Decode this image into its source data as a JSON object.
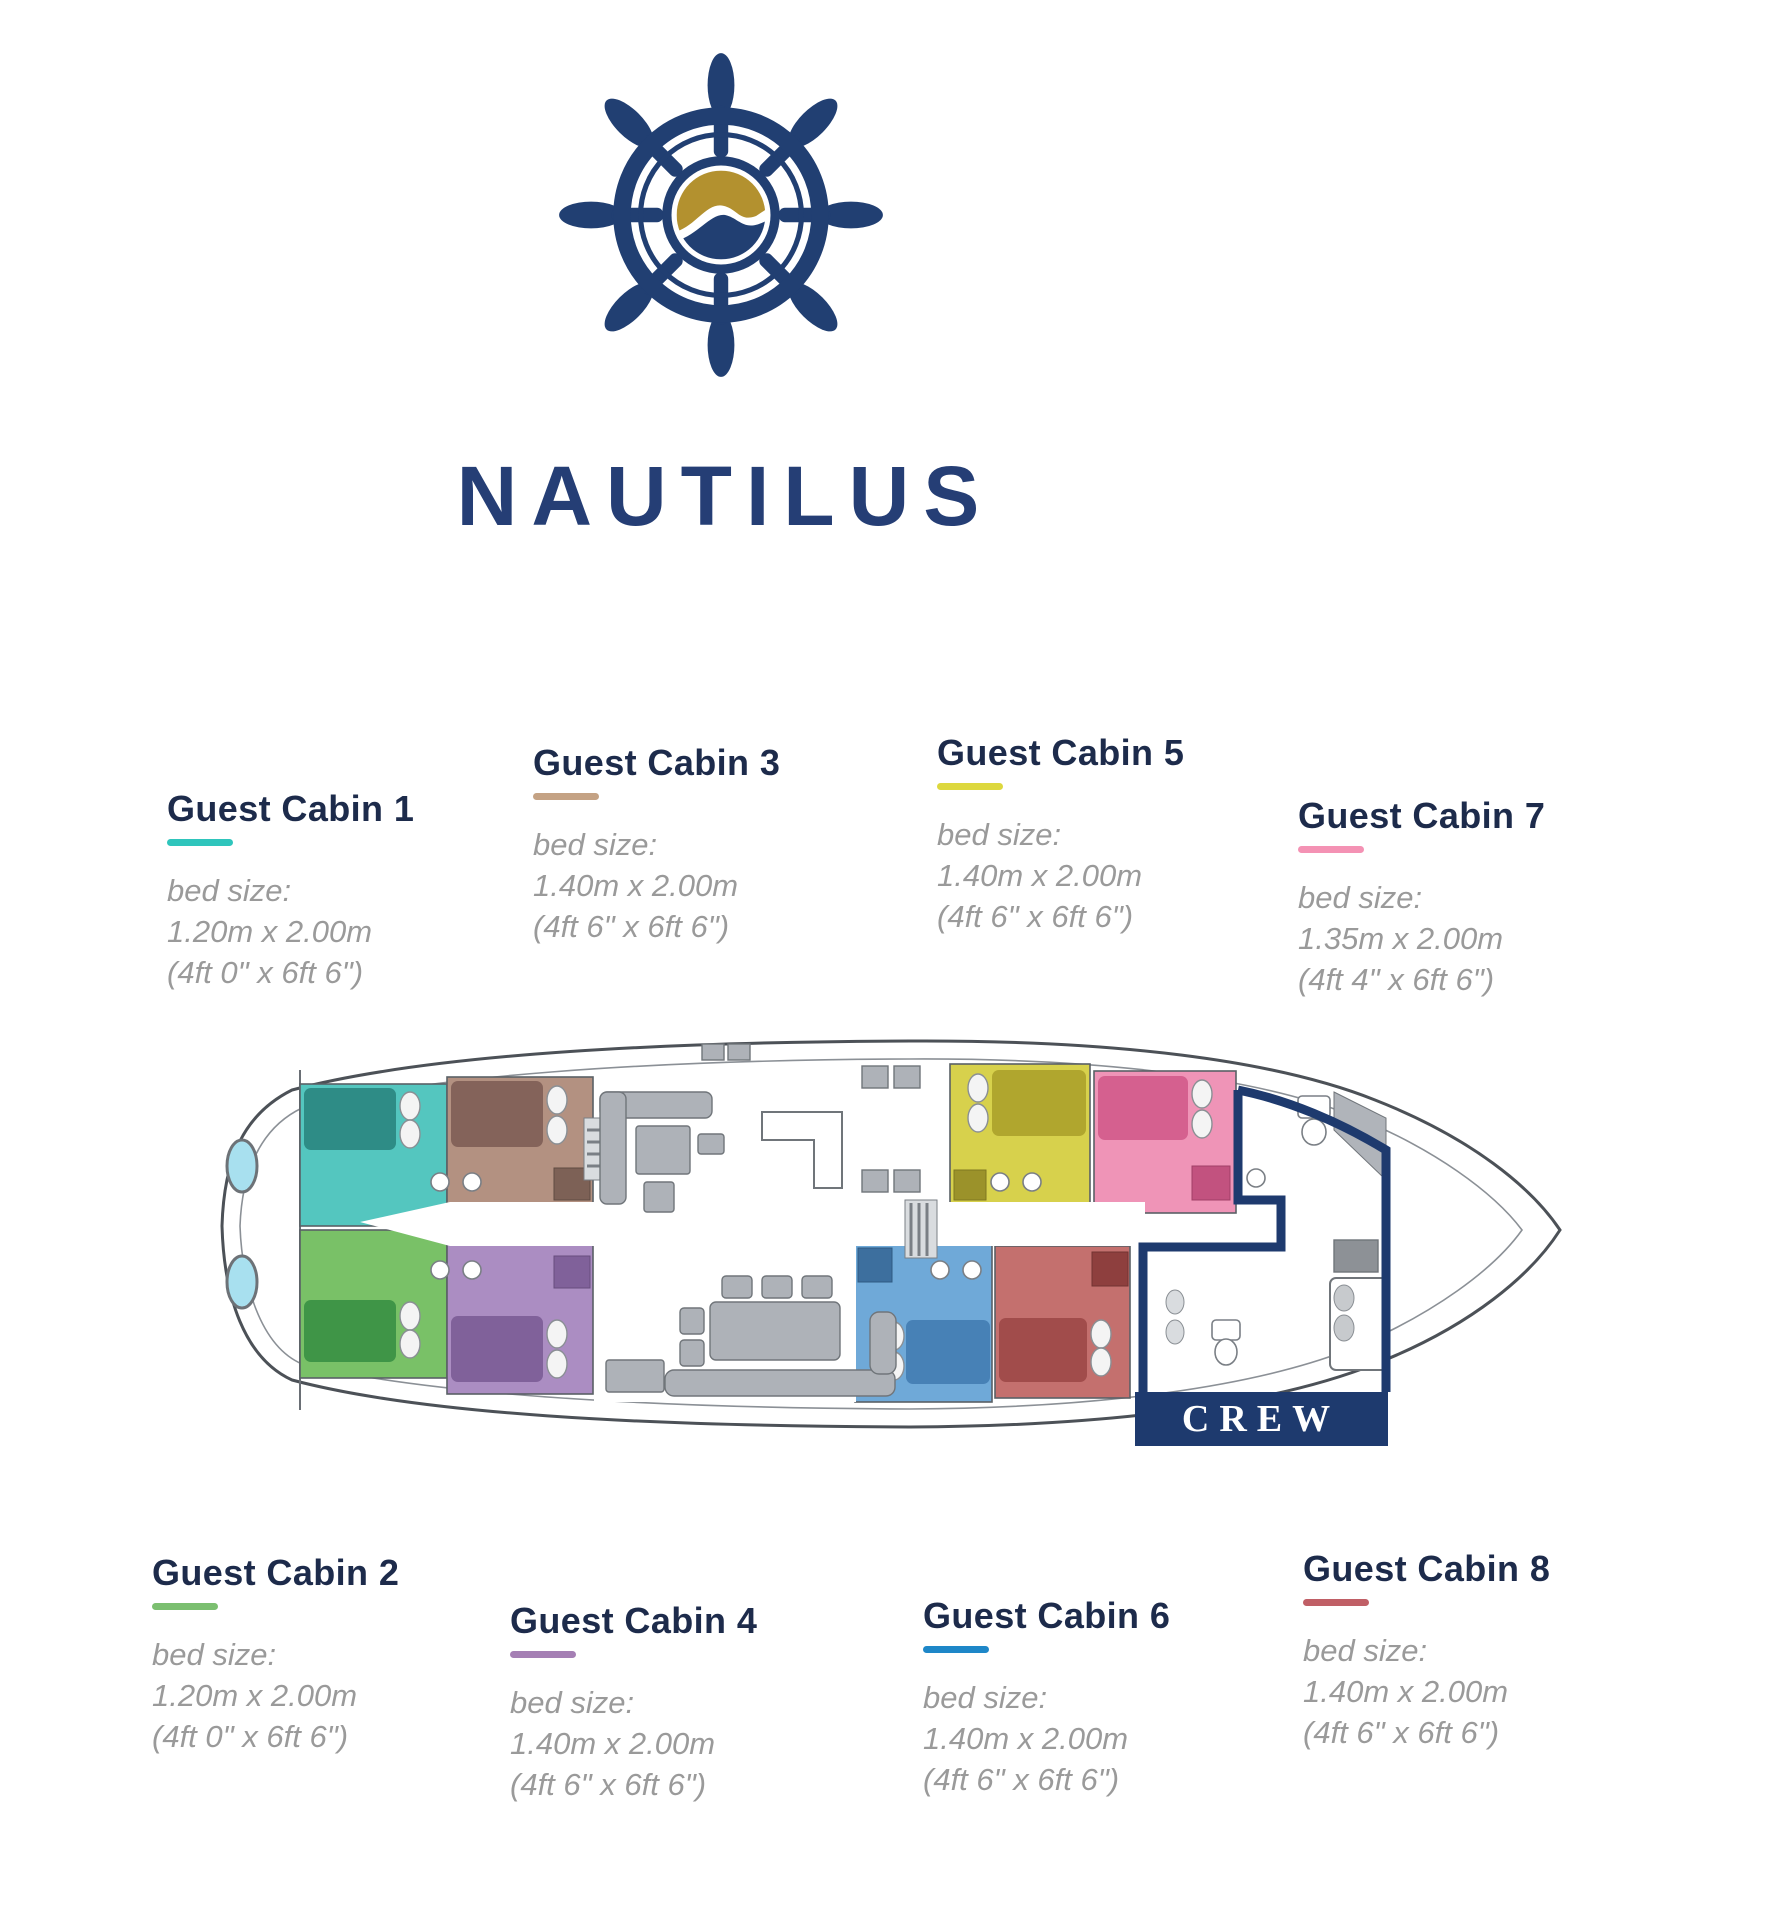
{
  "brand": {
    "name": "NAUTILUS"
  },
  "colors": {
    "navy": "#213f72",
    "gold": "#b3912f"
  },
  "crew": {
    "label": "CREW"
  },
  "cabins": [
    {
      "label": "Guest Cabin 1",
      "underline_color": "#2fc5bc",
      "fill": "#54c6bf",
      "bed_fill": "#2e8c86",
      "bed_size_label": "bed size:",
      "metric": "1.20m x 2.00m",
      "imperial": "(4ft 0\" x 6ft 6\")"
    },
    {
      "label": "Guest Cabin 2",
      "underline_color": "#7bbf70",
      "fill": "#79c167",
      "bed_fill": "#3f9547",
      "bed_size_label": "bed size:",
      "metric": "1.20m x 2.00m",
      "imperial": "(4ft 0\" x 6ft 6\")"
    },
    {
      "label": "Guest Cabin 3",
      "underline_color": "#c4a284",
      "fill": "#b39181",
      "bed_fill": "#84635a",
      "bed_size_label": "bed size:",
      "metric": "1.40m x 2.00m",
      "imperial": "(4ft 6\" x 6ft 6\")"
    },
    {
      "label": "Guest Cabin 4",
      "underline_color": "#a57fb4",
      "fill": "#ab8dc2",
      "bed_fill": "#80619a",
      "bed_size_label": "bed size:",
      "metric": "1.40m x 2.00m",
      "imperial": "(4ft 6\" x 6ft 6\")"
    },
    {
      "label": "Guest Cabin 5",
      "underline_color": "#ddd83e",
      "fill": "#d7d14c",
      "bed_fill": "#b0a62e",
      "bed_size_label": "bed size:",
      "metric": "1.40m x 2.00m",
      "imperial": "(4ft 6\" x 6ft 6\")"
    },
    {
      "label": "Guest Cabin 6",
      "underline_color": "#1e87c8",
      "fill": "#6fa9d8",
      "bed_fill": "#4781b6",
      "bed_size_label": "bed size:",
      "metric": "1.40m x 2.00m",
      "imperial": "(4ft 6\" x 6ft 6\")"
    },
    {
      "label": "Guest Cabin 7",
      "underline_color": "#f492b4",
      "fill": "#ef94b7",
      "bed_fill": "#d5608f",
      "bed_size_label": "bed size:",
      "metric": "1.35m x 2.00m",
      "imperial": "(4ft 4\" x 6ft 6\")"
    },
    {
      "label": "Guest Cabin 8",
      "underline_color": "#c05f66",
      "fill": "#c4706e",
      "bed_fill": "#a14c4b",
      "bed_size_label": "bed size:",
      "metric": "1.40m x 2.00m",
      "imperial": "(4ft 6\" x 6ft 6\")"
    }
  ]
}
